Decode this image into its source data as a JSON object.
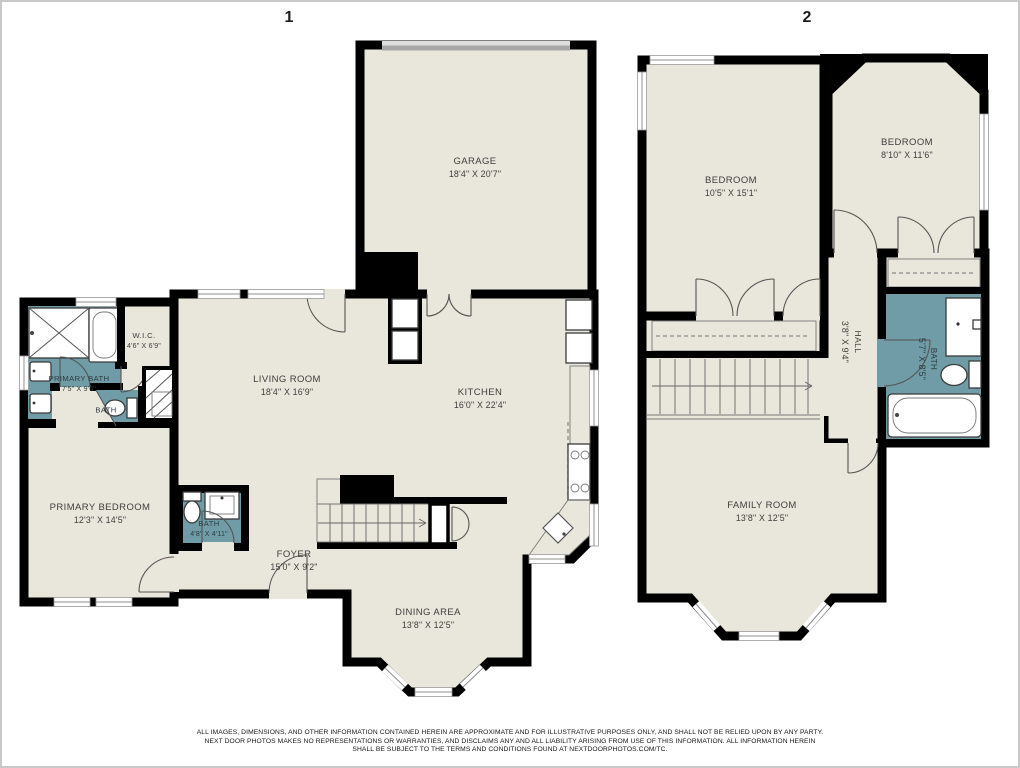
{
  "page": {
    "border_color": "#c9c9c9",
    "disclaimer": {
      "line1": "ALL IMAGES, DIMENSIONS, AND OTHER INFORMATION CONTAINED HEREIN ARE APPROXIMATE AND FOR ILLUSTRATIVE PURPOSES ONLY, AND SHALL NOT BE RELIED UPON BY ANY PARTY.",
      "line2": "NEXT DOOR PHOTOS MAKES NO REPRESENTATIONS OR WARRANTIES, AND DISCLAIMS ANY AND ALL LIABILITY ARISING FROM USE OF THIS INFORMATION.  ALL INFORMATION HEREIN",
      "line3": "SHALL BE SUBJECT TO THE TERMS AND CONDITIONS FOUND AT NEXTDOORPHOTOS.COM/TC."
    }
  },
  "colors": {
    "floor": "#e9e7dc",
    "bath_teal": "#6f9ca6",
    "wall": "#000000",
    "window_gray": "#8f8f8f",
    "garage_door_light": "#dedede",
    "garage_door_dark": "#a8a8a8"
  },
  "floors": [
    {
      "number": "1",
      "rooms": [
        {
          "name": "GARAGE",
          "dims": "18'4\" X 20'7\""
        },
        {
          "name": "LIVING ROOM",
          "dims": "18'4\" X 16'9\""
        },
        {
          "name": "KITCHEN",
          "dims": "16'0\" X 22'4\""
        },
        {
          "name": "PRIMARY BATH",
          "dims": "7'5\" X 9'6\""
        },
        {
          "name": "W.I.C.",
          "dims": "4'6\" X 6'9\""
        },
        {
          "name": "BATH",
          "dims": ""
        },
        {
          "name": "PRIMARY BEDROOM",
          "dims": "12'3\" X 14'5\""
        },
        {
          "name": "BATH",
          "dims": "4'8\" X 4'11\""
        },
        {
          "name": "FOYER",
          "dims": "15'0\" X 9'2\""
        },
        {
          "name": "DINING AREA",
          "dims": "13'8\" X 12'5\""
        }
      ]
    },
    {
      "number": "2",
      "rooms": [
        {
          "name": "BEDROOM",
          "dims": "10'5\" X 15'1\""
        },
        {
          "name": "BEDROOM",
          "dims": "8'10\" X 11'6\""
        },
        {
          "name": "HALL",
          "dims": "3'8\" X 9'4\""
        },
        {
          "name": "BATH",
          "dims": "5'7\" X 8'5\""
        },
        {
          "name": "FAMILY ROOM",
          "dims": "13'8\" X 12'5\""
        }
      ]
    }
  ]
}
